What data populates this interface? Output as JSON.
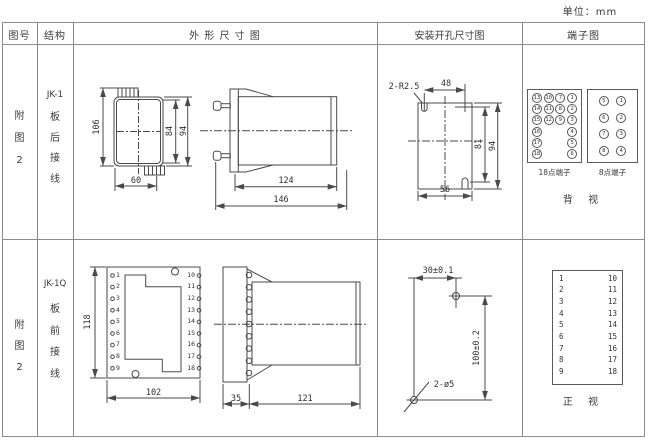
{
  "unit_label": "单位：mm",
  "table": {
    "headers": {
      "col_fig": "图号",
      "col_struct": "结构",
      "col_outline": "外 形 尺 寸 图",
      "col_mounting": "安装开孔尺寸图",
      "col_terminal": "端子图"
    }
  },
  "row1": {
    "fig_no": "附图2",
    "structure": {
      "model": "JK-1",
      "wiring": "板后接线"
    },
    "outline": {
      "dims": {
        "height_total": "106",
        "inner_height": "84",
        "case_height": "94",
        "width": "60",
        "body_len": "124",
        "total_len": "146"
      }
    },
    "mounting": {
      "dims": {
        "slot_label": "2-R2.5",
        "span_x": "48",
        "span_y": "81",
        "height": "94",
        "width": "56"
      }
    },
    "terminals": {
      "grid18": [
        "13",
        "10",
        "7",
        "1",
        "14",
        "11",
        "8",
        "2",
        "15",
        "12",
        "9",
        "3",
        "16",
        "",
        "",
        "4",
        "17",
        "",
        "",
        "5",
        "18",
        "",
        "",
        "6"
      ],
      "grid8": [
        "5",
        "1",
        "6",
        "2",
        "7",
        "3",
        "8",
        "4"
      ],
      "label18": "18点端子",
      "label8": "8点端子",
      "view_label": "背 视"
    }
  },
  "row2": {
    "fig_no": "附图2",
    "structure": {
      "model": "JK-1Q",
      "wiring": "板前接线"
    },
    "outline": {
      "left_terminals": [
        "1",
        "2",
        "3",
        "4",
        "5",
        "6",
        "7",
        "8",
        "9"
      ],
      "right_terminals": [
        "10",
        "11",
        "12",
        "13",
        "14",
        "15",
        "16",
        "17",
        "18"
      ],
      "dims": {
        "height": "118",
        "width": "102",
        "depth": "35",
        "body_len": "121"
      }
    },
    "mounting": {
      "dims": {
        "span_x": "30±0.1",
        "span_y": "100±0.2",
        "holes": "2-ø5"
      }
    },
    "terminals": {
      "left": [
        "1",
        "2",
        "3",
        "4",
        "5",
        "6",
        "7",
        "8",
        "9"
      ],
      "right": [
        "10",
        "11",
        "12",
        "13",
        "14",
        "15",
        "16",
        "17",
        "18"
      ],
      "view_label": "正 视"
    }
  }
}
